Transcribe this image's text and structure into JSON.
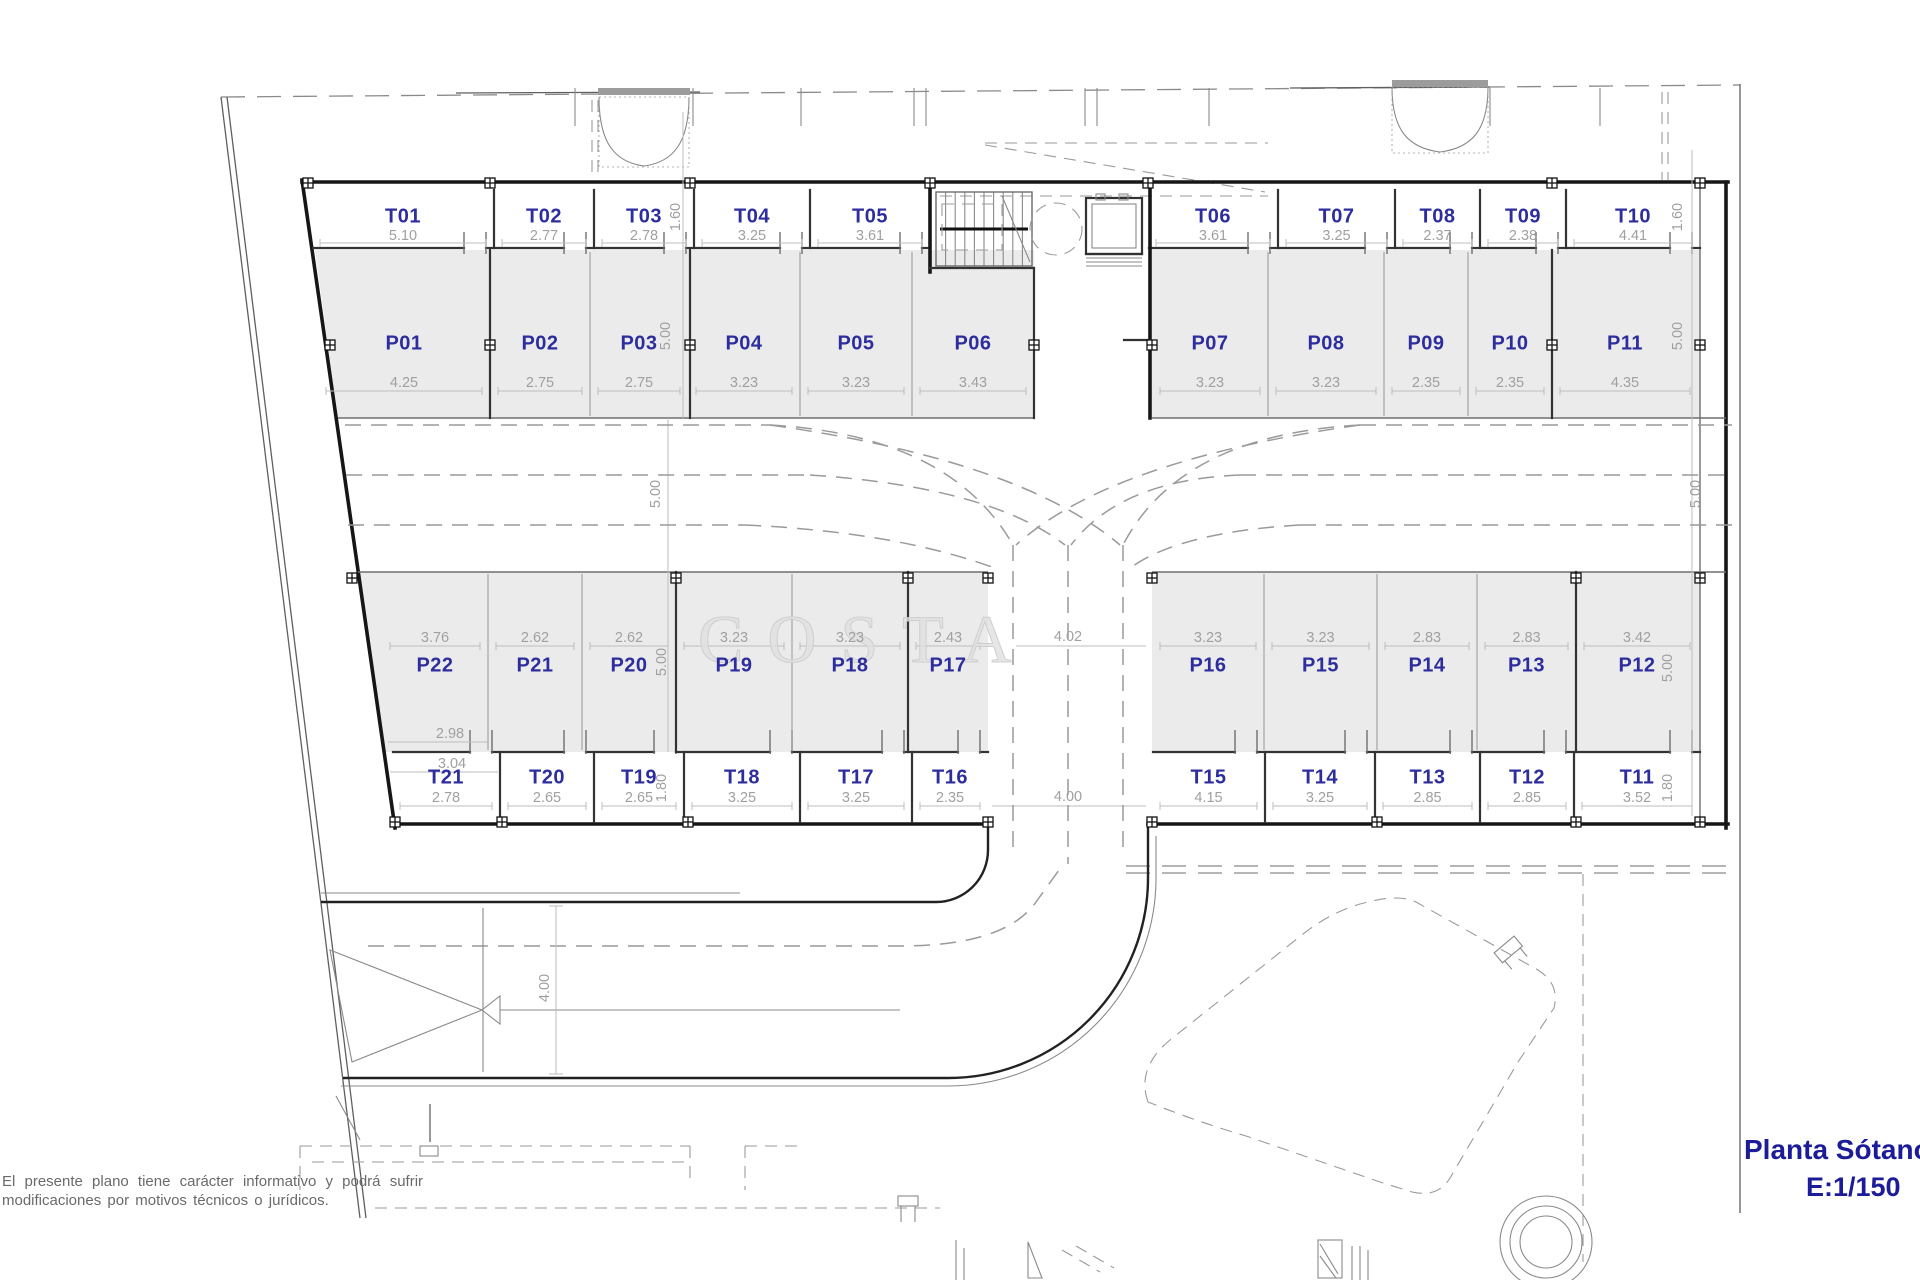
{
  "watermark": "COSTA",
  "title_block": {
    "line1": "Planta Sótano",
    "line2": "E:1/150"
  },
  "disclaimer": {
    "line1": "El presente plano tiene carácter informativo y podrá sufrir",
    "line2": "modificaciones por motivos técnicos o jurídicos."
  },
  "storage_top": [
    {
      "id": "T01",
      "width": "5.10"
    },
    {
      "id": "T02",
      "width": "2.77"
    },
    {
      "id": "T03",
      "width": "2.78"
    },
    {
      "id": "T04",
      "width": "3.25"
    },
    {
      "id": "T05",
      "width": "3.61"
    },
    {
      "id": "T06",
      "width": "3.61"
    },
    {
      "id": "T07",
      "width": "3.25"
    },
    {
      "id": "T08",
      "width": "2.37"
    },
    {
      "id": "T09",
      "width": "2.38"
    },
    {
      "id": "T10",
      "width": "4.41"
    }
  ],
  "parking_top": [
    {
      "id": "P01",
      "width": "4.25"
    },
    {
      "id": "P02",
      "width": "2.75"
    },
    {
      "id": "P03",
      "width": "2.75"
    },
    {
      "id": "P04",
      "width": "3.23"
    },
    {
      "id": "P05",
      "width": "3.23"
    },
    {
      "id": "P06",
      "width": "3.43"
    },
    {
      "id": "P07",
      "width": "3.23"
    },
    {
      "id": "P08",
      "width": "3.23"
    },
    {
      "id": "P09",
      "width": "2.35"
    },
    {
      "id": "P10",
      "width": "2.35"
    },
    {
      "id": "P11",
      "width": "4.35"
    }
  ],
  "parking_bottom": [
    {
      "id": "P22",
      "width": "3.76"
    },
    {
      "id": "P21",
      "width": "2.62"
    },
    {
      "id": "P20",
      "width": "2.62"
    },
    {
      "id": "P19",
      "width": "3.23"
    },
    {
      "id": "P18",
      "width": "3.23"
    },
    {
      "id": "P17",
      "width": "2.43"
    },
    {
      "id": "P16",
      "width": "3.23"
    },
    {
      "id": "P15",
      "width": "3.23"
    },
    {
      "id": "P14",
      "width": "2.83"
    },
    {
      "id": "P13",
      "width": "2.83"
    },
    {
      "id": "P12",
      "width": "3.42"
    }
  ],
  "storage_bottom": [
    {
      "id": "T21",
      "width": "2.78"
    },
    {
      "id": "T20",
      "width": "2.65"
    },
    {
      "id": "T19",
      "width": "2.65"
    },
    {
      "id": "T18",
      "width": "3.25"
    },
    {
      "id": "T17",
      "width": "3.25"
    },
    {
      "id": "T16",
      "width": "2.35"
    },
    {
      "id": "T15",
      "width": "4.15"
    },
    {
      "id": "T14",
      "width": "3.25"
    },
    {
      "id": "T13",
      "width": "2.85"
    },
    {
      "id": "T12",
      "width": "2.85"
    },
    {
      "id": "T11",
      "width": "3.52"
    }
  ],
  "extra_dims": [
    "1.60",
    "1.60",
    "5.00",
    "5.00",
    "5.00",
    "5.00",
    "5.00",
    "5.00",
    "1.80",
    "1.80",
    "4.02",
    "4.00",
    "2.98",
    "3.04",
    "4.00"
  ],
  "colors": {
    "label": "#2d2d9e",
    "dimension": "#a0a0a0",
    "title": "#1c1c99",
    "parking_fill": "#ebebeb"
  }
}
